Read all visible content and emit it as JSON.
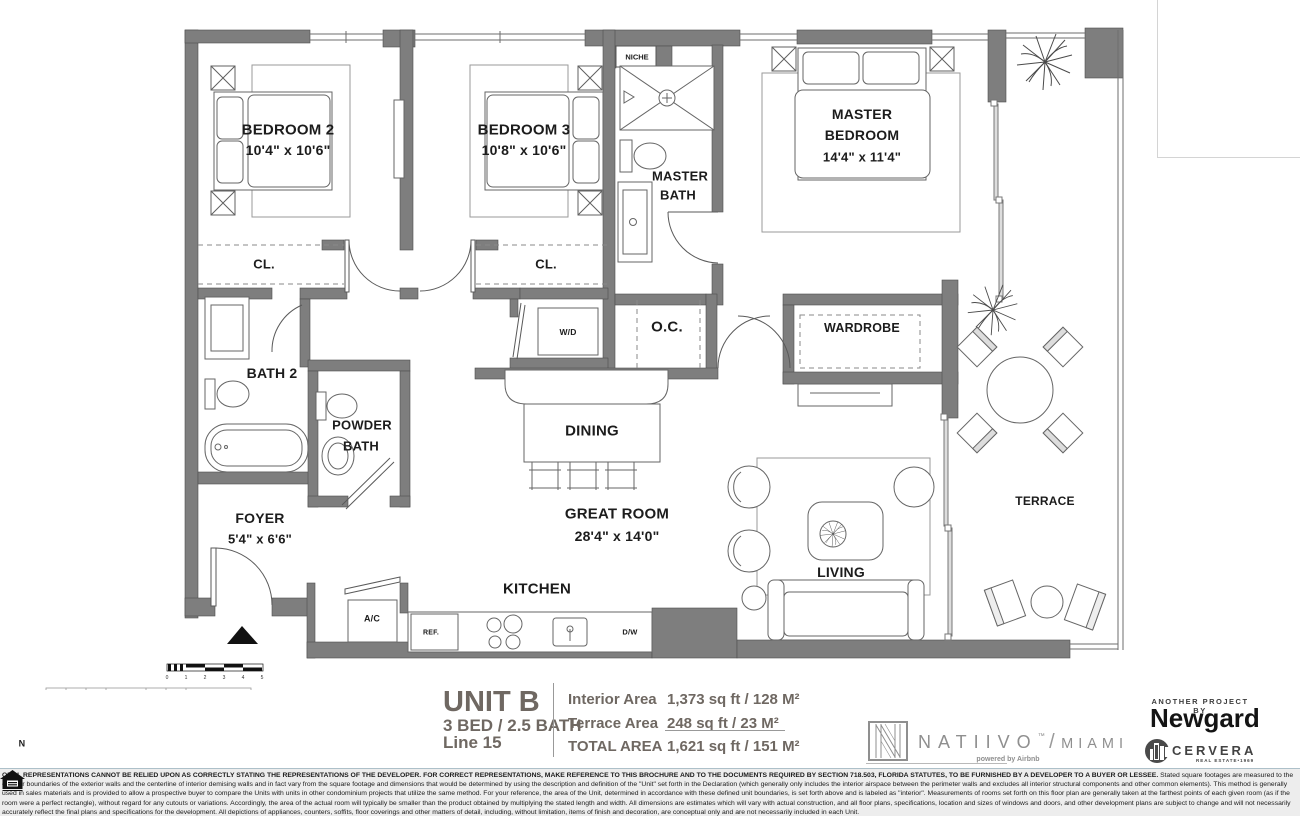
{
  "floor_plan": {
    "rooms": {
      "bedroom2": {
        "name": "BEDROOM 2",
        "dims": "10'4\" x 10'6\""
      },
      "bedroom3": {
        "name": "BEDROOM 3",
        "dims": "10'8\" x 10'6\""
      },
      "master_bedroom": {
        "line1": "MASTER",
        "line2": "BEDROOM",
        "dims": "14'4\" x 11'4\""
      },
      "master_bath": {
        "line1": "MASTER",
        "line2": "BATH"
      },
      "bath2": {
        "name": "BATH 2"
      },
      "powder": {
        "line1": "POWDER",
        "line2": "BATH"
      },
      "foyer": {
        "name": "FOYER",
        "dims": "5'4\" x 6'6\""
      },
      "great_room": {
        "name": "GREAT ROOM",
        "dims": "28'4\" x 14'0\""
      },
      "dining": {
        "name": "DINING"
      },
      "kitchen": {
        "name": "KITCHEN"
      },
      "living": {
        "name": "LIVING"
      },
      "terrace": {
        "name": "TERRACE"
      },
      "wardrobe": {
        "name": "WARDROBE"
      },
      "oc": {
        "name": "O.C."
      },
      "wd": {
        "name": "W/D"
      },
      "niche": {
        "name": "NICHE"
      },
      "cl2": {
        "name": "CL."
      },
      "cl3": {
        "name": "CL."
      },
      "ac": {
        "name": "A/C"
      },
      "ref": {
        "name": "REF."
      },
      "dw": {
        "name": "D/W"
      }
    },
    "compass": {
      "label": "N"
    },
    "scale_bar": {
      "labels": [
        "0",
        "1",
        "2",
        "3",
        "4",
        "5"
      ]
    }
  },
  "footer": {
    "unit": {
      "name": "UNIT B",
      "type": "3 BED / 2.5 BATH",
      "line": "Line 15"
    },
    "areas": {
      "interior": {
        "label": "Interior Area",
        "value": "1,373 sq ft / 128 M²"
      },
      "terrace": {
        "label": "Terrace Area",
        "value": "248 sq ft / 23 M²"
      },
      "total": {
        "label": "TOTAL AREA",
        "value": "1,621 sq ft / 151 M²"
      }
    },
    "brand": {
      "name": "NATIIVO",
      "tm": "™",
      "separator": "/",
      "city": "MIAMI",
      "powered_by": "powered by Airbnb"
    },
    "developer": {
      "tagline": "ANOTHER PROJECT BY",
      "name": "Newgard"
    },
    "broker": {
      "name": "CERVERA",
      "subtitle": "REAL ESTATE•1969"
    }
  },
  "disclaimer": {
    "line1": "ORAL REPRESENTATIONS CANNOT BE RELIED UPON AS CORRECTLY STATING THE REPRESENTATIONS OF THE DEVELOPER.  FOR CORRECT REPRESENTATIONS, MAKE REFERENCE TO THIS BROCHURE AND TO THE DOCUMENTS REQUIRED BY SECTION 718.503, FLORIDA STATUTES, TO BE FURNISHED BY A DEVELOPER TO A BUYER OR LESSEE.",
    "body": "Stated square footages are measured to the exterior boundaries of the exterior walls and the centerline of interior demising walls and in fact vary from the square footage and dimensions that would be determined by using the description and definition of the \"Unit\" set forth in the Declaration (which generally only includes the interior airspace between the perimeter walls and excludes all interior structural components and other common elements). This method is generally used in sales materials and is provided to allow a prospective buyer to compare the Units with units in other condominium projects that utilize the same method. For your reference, the area of the Unit, determined in accordance with these defined unit boundaries, is set forth above and is labeled as \"interior\". Measurements of rooms set forth on this floor plan are generally taken at the farthest points of each given room (as if the room were a perfect rectangle), without regard for any cutouts or variations.  Accordingly, the area of the actual room will typically be smaller than the product obtained by multiplying the stated length and width.  All dimensions are estimates which will vary with actual construction, and all floor plans, specifications, location and sizes of windows and doors, and other development plans are subject to change and will not necessarily accurately reflect the final plans and specifications for the development. All depictions of appliances, counters, soffits, floor coverings and other matters of detail, including, without limitation, items of finish and decoration, are conceptual only and are not necessarily included in each Unit."
  },
  "colors": {
    "wall": "#7e7e7e",
    "accent_text": "#6f6862",
    "line": "#606060",
    "unit_highlight": "#c9c9c9"
  }
}
